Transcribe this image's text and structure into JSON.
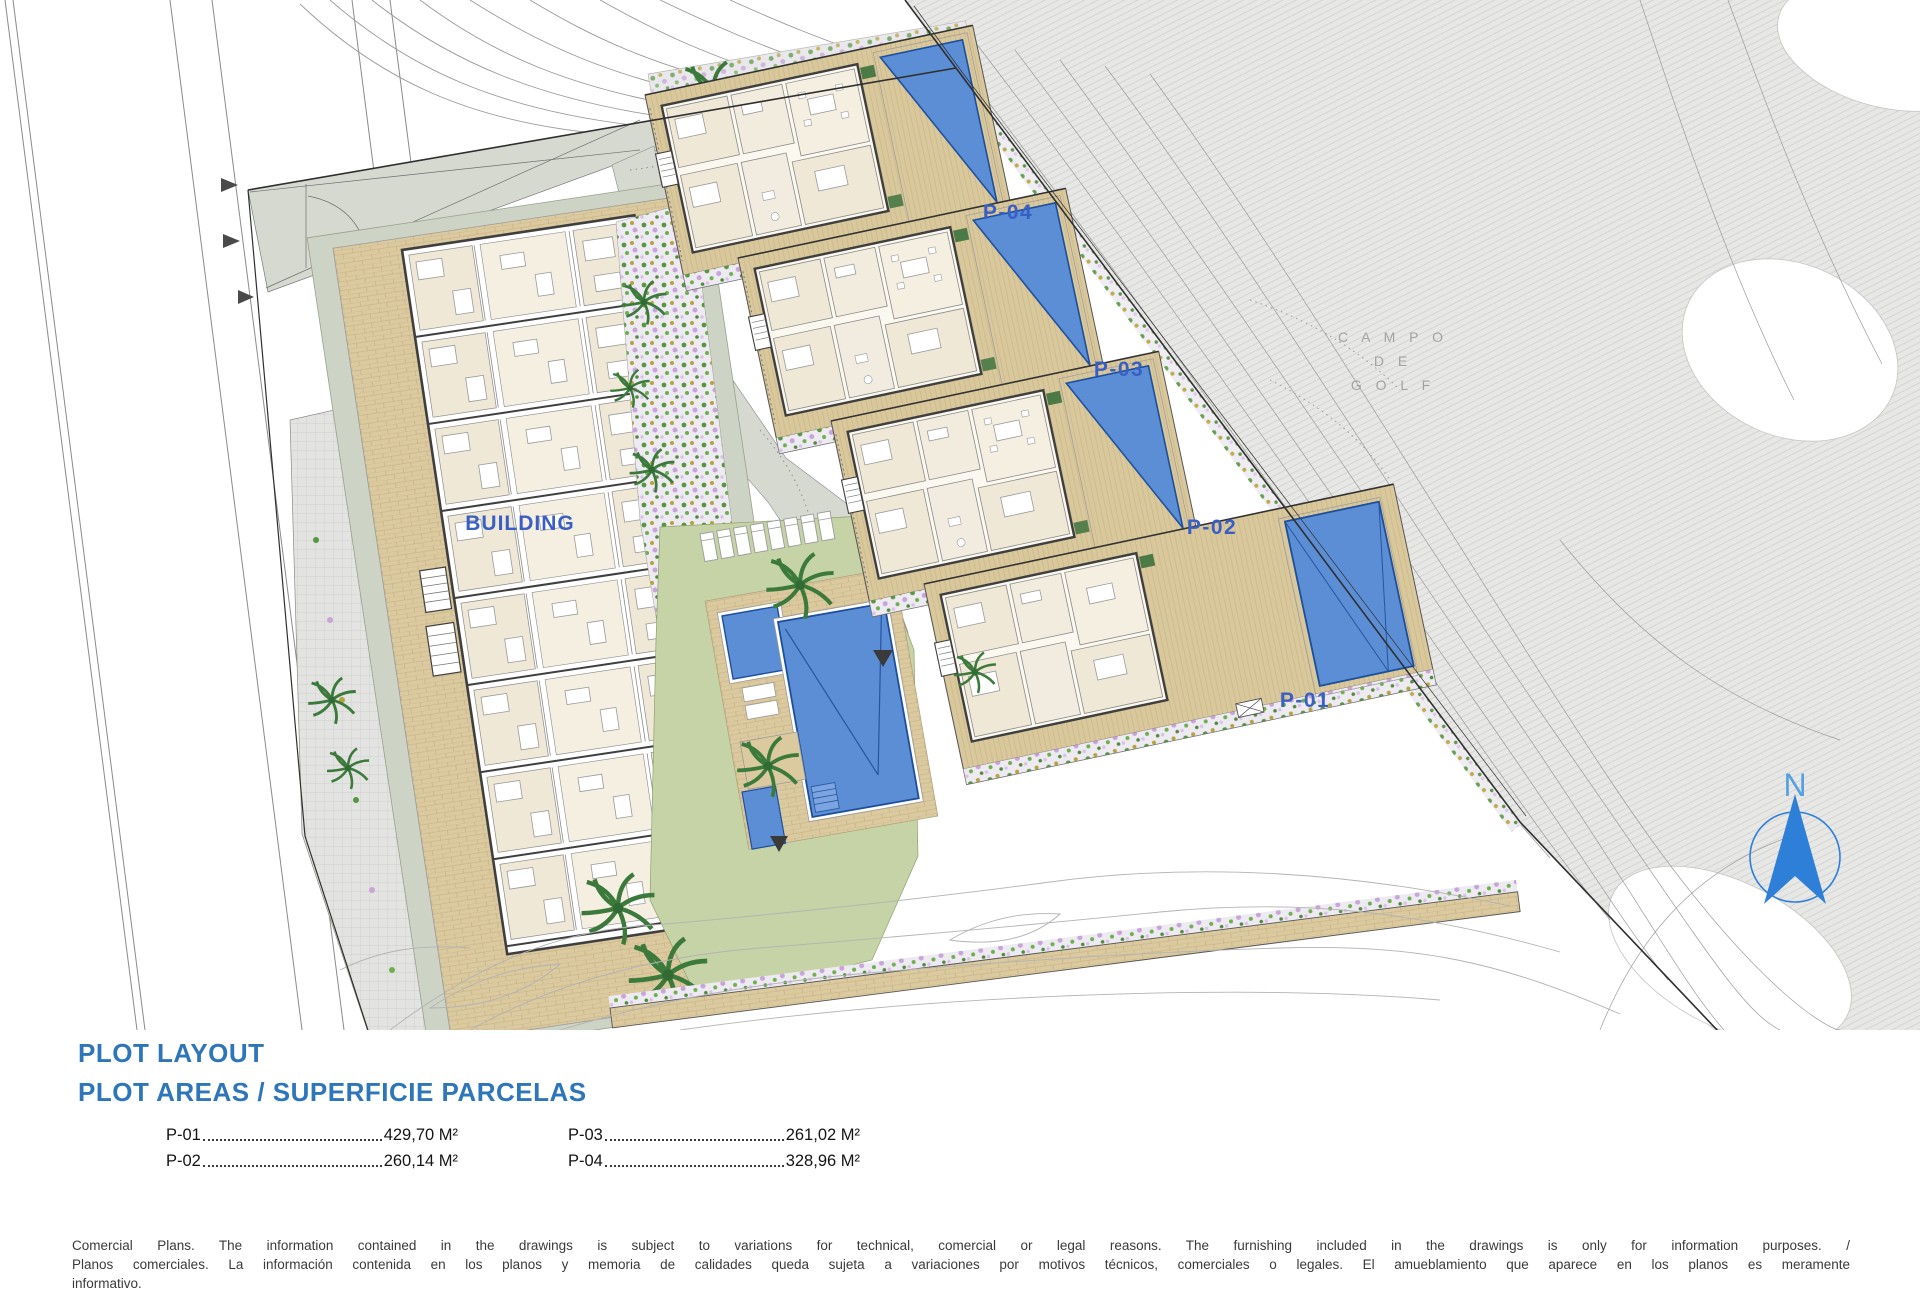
{
  "plan": {
    "building_label": "BUILDING",
    "plot_labels": {
      "p01": "P-01",
      "p02": "P-02",
      "p03": "P-03",
      "p04": "P-04"
    },
    "golf_label": {
      "line1": "C A M P O",
      "line2": "D E",
      "line3": "G O L F"
    },
    "north_label": "N"
  },
  "legend": {
    "title_line1": "PLOT LAYOUT",
    "title_line2": "PLOT AREAS / SUPERFICIE PARCELAS",
    "entries": [
      {
        "label": "P-01",
        "value": "429,70 M²"
      },
      {
        "label": "P-02",
        "value": "260,14 M²"
      },
      {
        "label": "P-03",
        "value": "261,02 M²"
      },
      {
        "label": "P-04",
        "value": "328,96 M²"
      }
    ]
  },
  "disclaimer": {
    "line1": "Comercial Plans. The information contained in the drawings is subject to variations for technical, comercial or legal reasons. The furnishing included in the drawings is only for information purposes. /",
    "line2": "Planos comerciales. La información contenida en los planos y memoria de calidades queda sujeta a variaciones por motivos técnicos, comerciales o legales. El amueblamiento que aparece en los planos es meramente",
    "line3": "informativo."
  },
  "colors": {
    "title_blue": "#2d76ba",
    "label_blue": "#3a5fc4",
    "pool_blue": "#5c8ed6",
    "north_blue": "#2e7fd8",
    "terrace_tan": "#dbc99f",
    "lawn_green": "#c5d3a6",
    "golf_gray": "#e7e7e5"
  }
}
